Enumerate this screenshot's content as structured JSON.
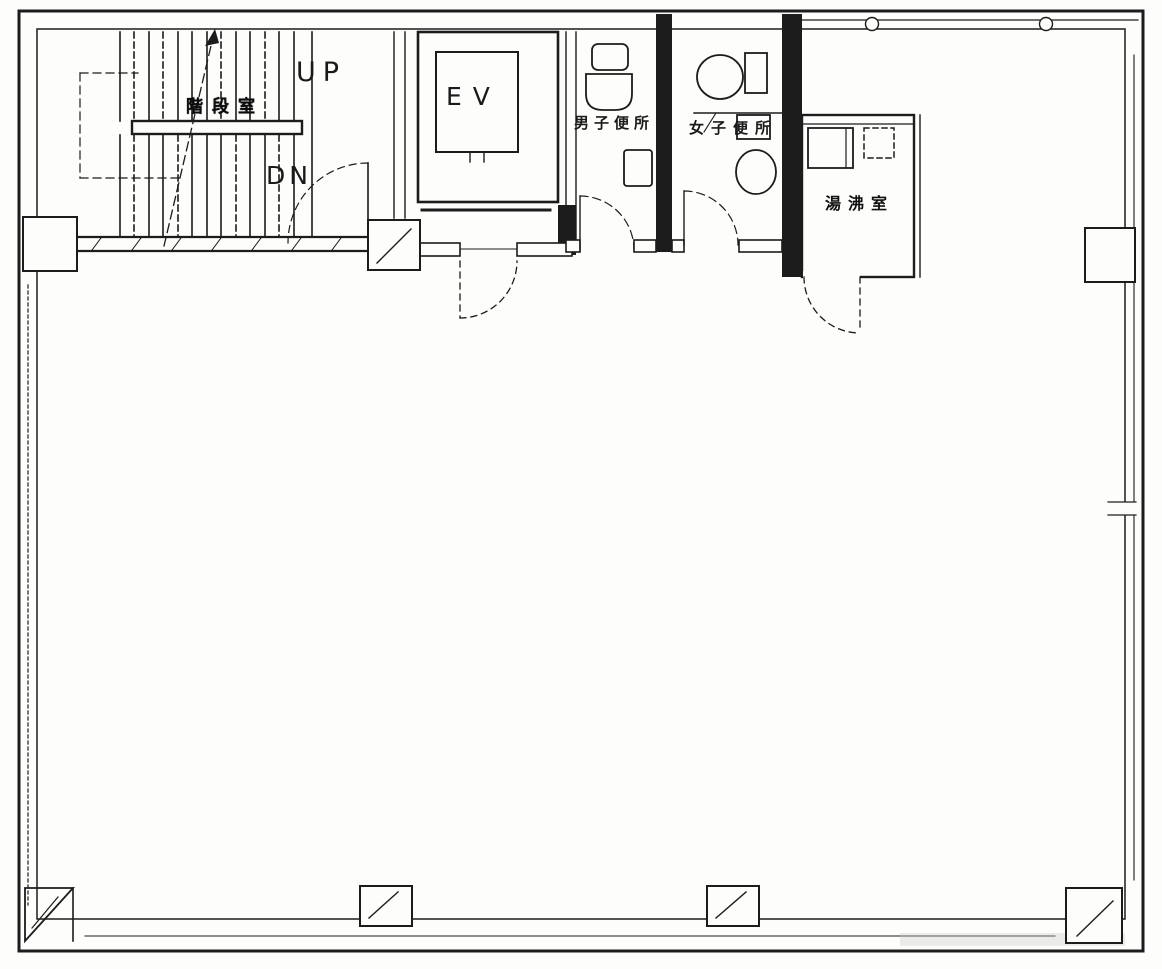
{
  "page": {
    "title": "Office building floor plan (scanned architectural drawing)",
    "type": "floor-plan"
  },
  "colors": {
    "ink": "#1c1c1c",
    "paper": "#fdfdfb"
  },
  "plan": {
    "stairwell": {
      "label": "階段室",
      "up": "UP",
      "down": "DN"
    },
    "elevator": {
      "label": "EV"
    },
    "mens_toilet": {
      "label": "男子便所",
      "fixtures": [
        "urinal",
        "toilet",
        "wash-basin"
      ]
    },
    "womens_toilet": {
      "label": "女子便所",
      "fixtures": [
        "toilet",
        "toilet"
      ]
    },
    "hot_water_room": {
      "label": "湯沸室",
      "fixtures": [
        "sink-counter",
        "water-heater"
      ]
    },
    "main_area": {
      "label": ""
    }
  }
}
